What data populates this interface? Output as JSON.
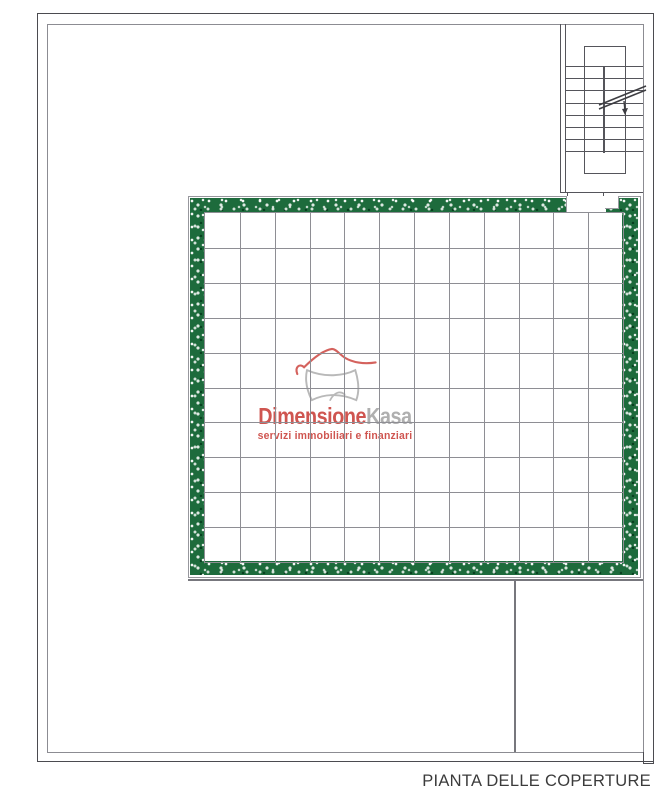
{
  "document": {
    "type": "architectural-roof-plan",
    "title": "PIANTA DELLE COPERTURE"
  },
  "watermark": {
    "brand": {
      "primary": "Dimensione",
      "secondary": "Kasa"
    },
    "tagline": "servizi immobiliari e finanziari",
    "icon": "house-sketch-icon",
    "colors": {
      "brand_red": "#cb4742",
      "brand_gray": "#a9a9a9"
    }
  },
  "plan": {
    "colors": {
      "hedge_green": "#1d6b3c",
      "outer_border": "#4b4b50",
      "inner_border": "#8c8c92",
      "grid_line": "#8e8e94",
      "stair_line": "#55555b",
      "building_line": "#77777d",
      "title_text": "#3b3b3b"
    },
    "roof_grid": {
      "columns": 12,
      "rows": 10
    },
    "staircase": {
      "tread_count": 8,
      "tread_spacing": 12.2
    }
  }
}
